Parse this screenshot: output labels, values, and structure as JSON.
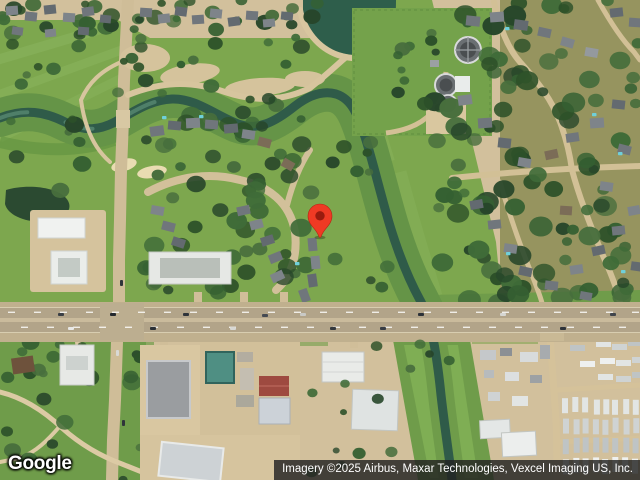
{
  "branding": {
    "logo_text": "Google"
  },
  "attribution": {
    "text": "Imagery ©2025 Airbus, Maxar Technologies, Vexcel Imaging US, Inc."
  },
  "map": {
    "view_type": "satellite",
    "pin": {
      "screen_x": 320,
      "screen_y": 238
    }
  },
  "icons": {
    "marker": "location-pin"
  },
  "colors": {
    "pin_red": "#ef3a24",
    "pin_inner": "#991b0e",
    "pin_stroke": "#b52715",
    "logo_text_color": "#ffffff",
    "attribution_text": "#ffffff",
    "terrain_grass": "#7da74e",
    "terrain_grass_dark": "#659447",
    "terrain_water": "#2f5b49",
    "terrain_sand": "#d2c09c",
    "terrain_road": "#b2a489",
    "roof_teal": "#4f8f83",
    "roof_red": "#9e4a40"
  }
}
